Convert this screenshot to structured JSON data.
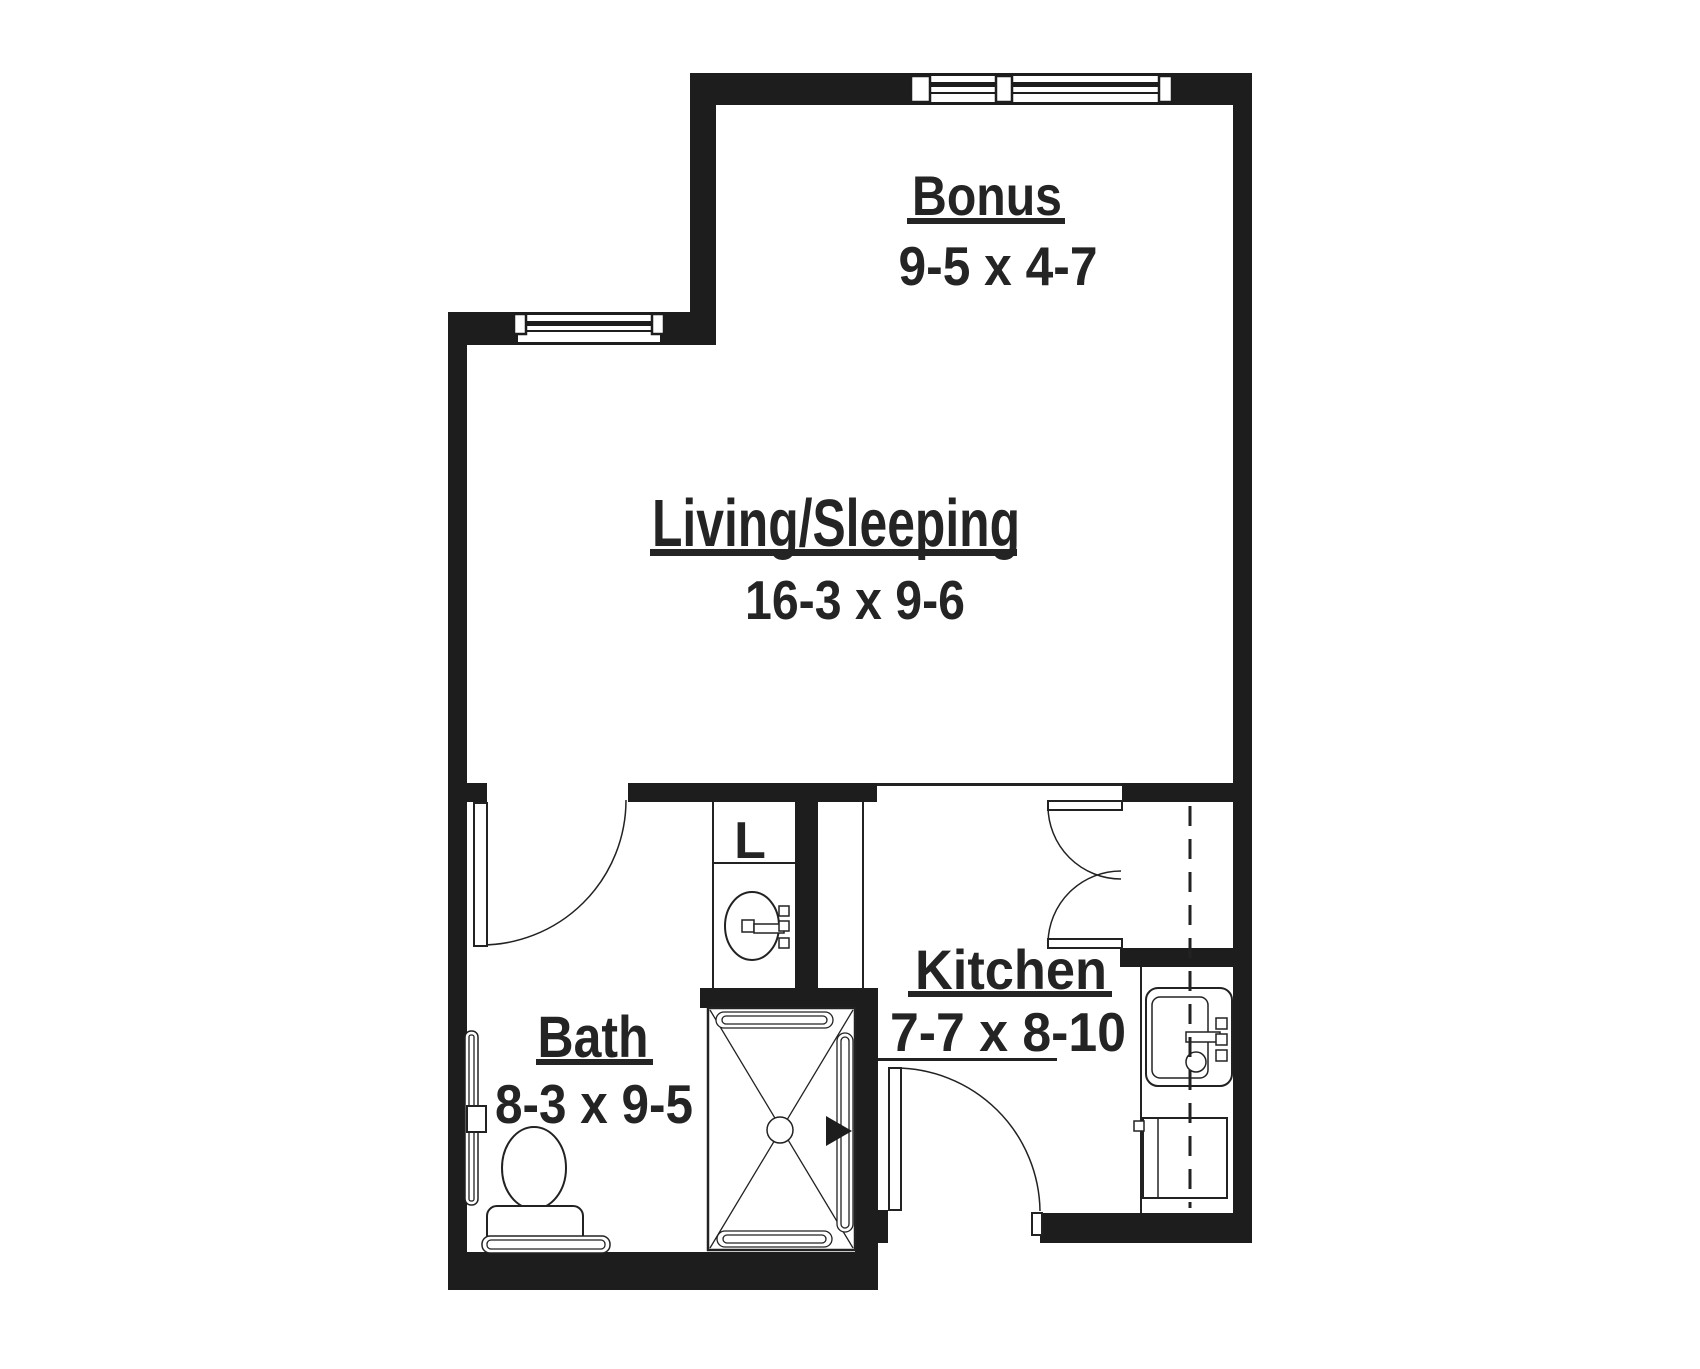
{
  "palette": {
    "background": "#ffffff",
    "wall": "#1d1d1d",
    "line": "#222222",
    "text": "#242424"
  },
  "rooms": {
    "bonus": {
      "label": "Bonus",
      "dims": "9-5 x 4-7"
    },
    "living": {
      "label": "Living/Sleeping",
      "dims": "16-3 x 9-6"
    },
    "bath": {
      "label": "Bath",
      "dims": "8-3 x 9-5"
    },
    "kitchen": {
      "label": "Kitchen",
      "dims": "7-7 x 8-10"
    },
    "closet": {
      "label": "L"
    }
  }
}
